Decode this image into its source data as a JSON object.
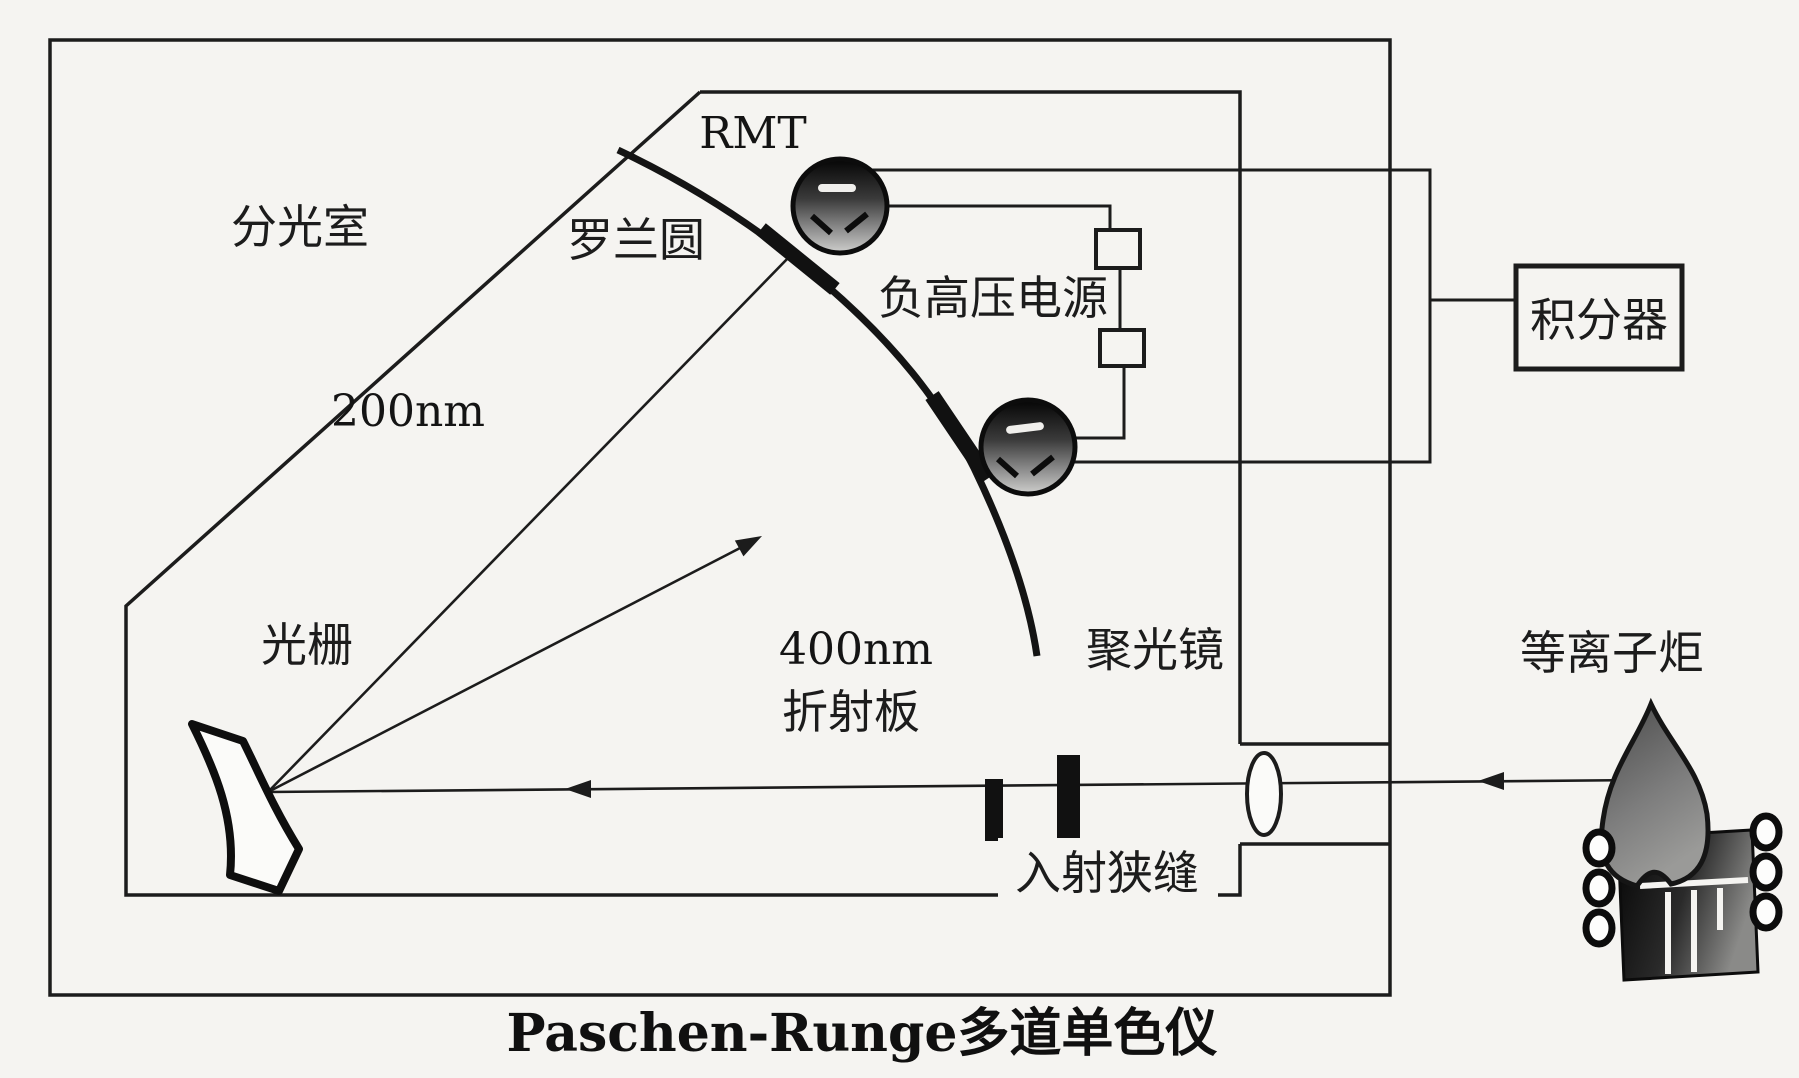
{
  "figure": {
    "title": "Paschen-Runge多道单色仪",
    "labels": {
      "spectral_chamber": "分光室",
      "rowland_circle": "罗兰圆",
      "detector_rmt": "RMT",
      "wavelength_200": "200nm",
      "neg_hv_supply": "负高压电源",
      "integrator": "积分器",
      "grating": "光栅",
      "wavelength_400": "400nm",
      "refraction_plate": "折射板",
      "condenser_lens": "聚光镜",
      "entrance_slit": "入射狭缝",
      "plasma_torch": "等离子炬"
    },
    "colors": {
      "ink": "#1c1c1c",
      "paper": "#f5f4f1"
    }
  }
}
